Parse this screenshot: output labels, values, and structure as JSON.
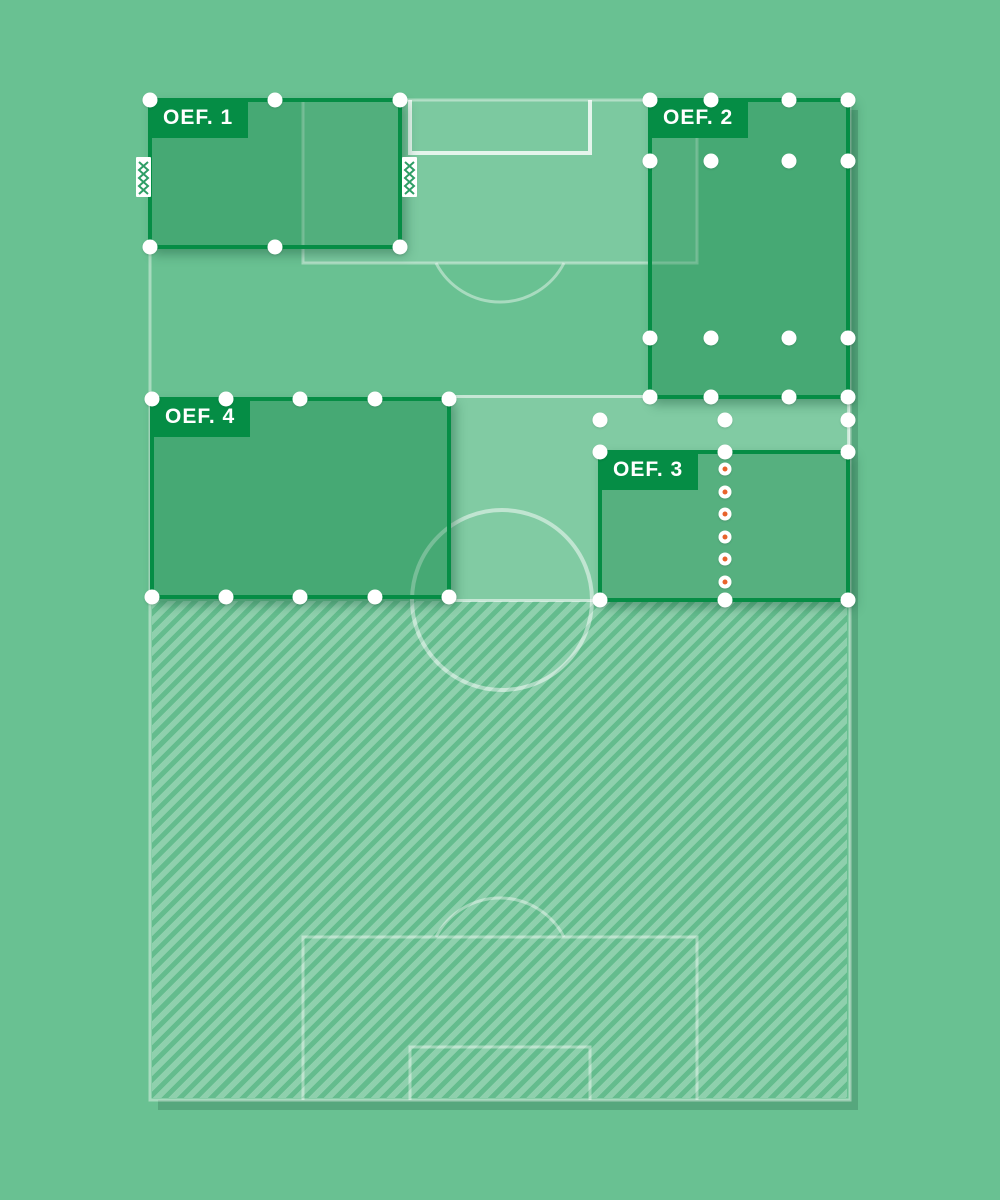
{
  "canvas": {
    "width": 1000,
    "height": 1200
  },
  "colors": {
    "background": "#69c192",
    "zone_border": "#058d45",
    "zone_fill": "rgba(5,125,60,0.35)",
    "badge_bg": "#058d45",
    "badge_text": "#ffffff",
    "line_light": "rgba(255,255,255,0.42)",
    "line_bright": "rgba(255,255,255,0.8)",
    "penalty_fill": "rgba(255,255,255,0.13)",
    "light_zone_fill": "rgba(255,255,255,0.16)",
    "light_zone_border": "rgba(255,255,255,0.55)",
    "handle": "#ffffff",
    "waypoint_center": "#e8632c",
    "goal_net": "#2f9e66",
    "pitch_shadow": "rgba(30,90,62,0.25)",
    "zone_shadow": "rgba(25,85,58,0.4)"
  },
  "pitch": {
    "x": 150,
    "y": 100,
    "w": 700,
    "h": 1000,
    "penalty_box_top": {
      "x1": 303,
      "y1": 100,
      "x2": 697,
      "y2": 263
    },
    "goal_box_top": {
      "x1": 410,
      "y1": 100,
      "x2": 590,
      "y2": 153
    },
    "arc_top": {
      "x1": 436,
      "x2": 564,
      "y": 263,
      "r": 72
    },
    "center_circle": {
      "cx": 502,
      "cy": 600,
      "r": 90
    },
    "penalty_box_bottom": {
      "x1": 303,
      "y1": 937,
      "x2": 697,
      "y2": 1100
    },
    "goal_box_bottom": {
      "x1": 410,
      "y1": 1047,
      "x2": 590,
      "y2": 1100
    },
    "arc_bottom": {
      "x1": 436,
      "x2": 564,
      "y": 937,
      "r": 72
    },
    "halfway_y": 600
  },
  "hatch_area": {
    "x": 152,
    "y": 601,
    "w": 695,
    "h": 497
  },
  "light_zone": {
    "x": 450,
    "y": 397,
    "w": 398,
    "h": 203,
    "handles": [
      [
        600,
        420
      ],
      [
        725,
        420
      ],
      [
        848,
        420
      ]
    ]
  },
  "zones": [
    {
      "label": "OEF. 1",
      "x": 150,
      "y": 100,
      "w": 250,
      "h": 147,
      "handles": [
        [
          150,
          100
        ],
        [
          275,
          100
        ],
        [
          400,
          100
        ],
        [
          150,
          247
        ],
        [
          275,
          247
        ],
        [
          400,
          247
        ]
      ]
    },
    {
      "label": "OEF. 2",
      "x": 650,
      "y": 100,
      "w": 198,
      "h": 297,
      "handles": [
        [
          650,
          100
        ],
        [
          711,
          100
        ],
        [
          789,
          100
        ],
        [
          848,
          100
        ],
        [
          650,
          161
        ],
        [
          711,
          161
        ],
        [
          789,
          161
        ],
        [
          848,
          161
        ],
        [
          650,
          338
        ],
        [
          711,
          338
        ],
        [
          789,
          338
        ],
        [
          848,
          338
        ],
        [
          650,
          397
        ],
        [
          711,
          397
        ],
        [
          789,
          397
        ],
        [
          848,
          397
        ]
      ]
    },
    {
      "label": "OEF. 3",
      "x": 600,
      "y": 452,
      "w": 248,
      "h": 148,
      "handles": [
        [
          600,
          452
        ],
        [
          725,
          452
        ],
        [
          848,
          452
        ],
        [
          600,
          600
        ],
        [
          725,
          600
        ],
        [
          848,
          600
        ]
      ]
    },
    {
      "label": "OEF. 4",
      "x": 152,
      "y": 399,
      "w": 297,
      "h": 198,
      "handles": [
        [
          152,
          399
        ],
        [
          226,
          399
        ],
        [
          300,
          399
        ],
        [
          375,
          399
        ],
        [
          449,
          399
        ],
        [
          152,
          597
        ],
        [
          226,
          597
        ],
        [
          300,
          597
        ],
        [
          375,
          597
        ],
        [
          449,
          597
        ]
      ]
    }
  ],
  "waypoint_line": {
    "x": 725,
    "ys": [
      469,
      492,
      514,
      537,
      559,
      582
    ]
  },
  "goals": [
    {
      "x": 136,
      "y": 157
    },
    {
      "x": 402,
      "y": 157
    }
  ]
}
